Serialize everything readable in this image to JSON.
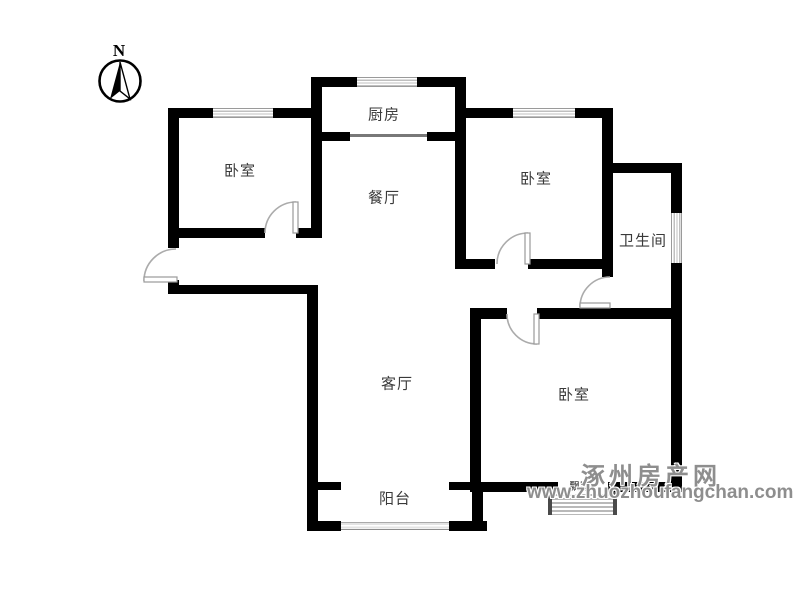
{
  "compass": {
    "north": "N"
  },
  "labels": {
    "kitchen": "厨房",
    "dining": "餐厅",
    "bedroom_top_left": "卧室",
    "bedroom_top_right": "卧室",
    "bedroom_bottom_right": "卧室",
    "bathroom": "卫生间",
    "living_room": "客厅",
    "balcony": "阳台",
    "bay_window": "飘窗"
  },
  "watermark": {
    "name": "涿州房产网",
    "url": "www.zhuozhoufangchan.com"
  },
  "colors": {
    "wall": "#000000",
    "window_line": "#bfbfbf",
    "door_arc": "#ababab",
    "label_text": "#3a3a3a",
    "watermark_gray": "#8e8e8e"
  }
}
